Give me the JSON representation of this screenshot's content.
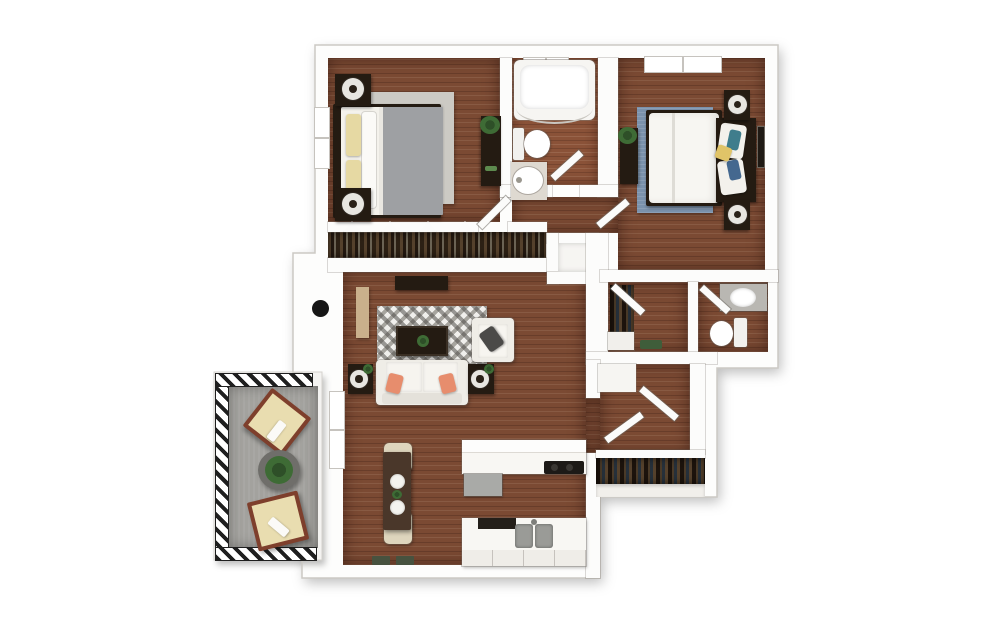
{
  "plan_title": "Two bedroom one and a half bath apartment 3D floor plan with balcony",
  "rooms": {
    "bedroom1": "Bedroom 1",
    "bathroom1": "Bathroom 1",
    "bedroom2": "Bedroom 2",
    "closet1": "Bedroom 1 wardrobe closet",
    "walkin_closet": "Walk-in closet",
    "bathroom2": "Bathroom 2",
    "living": "Living and dining room",
    "kitchen": "Kitchen",
    "hall": "Hallway",
    "hall_closet": "Hall closet",
    "entry": "Entry vestibule",
    "balcony": "Balcony"
  },
  "furniture": {
    "bedroom1": [
      "queen bed with gray comforter and yellow pillows",
      "two nightstands with lamps",
      "area rug",
      "dresser with plant",
      "window"
    ],
    "bathroom1": [
      "bathtub with shower curtain rod",
      "toilet",
      "pedestal sink"
    ],
    "bedroom2": [
      "queen bed with white comforter and blue accent pillows",
      "two nightstands with lamps",
      "blue area rug",
      "dresser with plant",
      "wall art",
      "window"
    ],
    "living": [
      "tv console",
      "tall cabinet",
      "geometric area rug",
      "coffee table with plant",
      "sofa with coral pillows",
      "two end tables with lamp and plant",
      "armchair with gray pillow"
    ],
    "dining": [
      "dining table",
      "two chairs",
      "two place settings",
      "centerpiece plant"
    ],
    "kitchen": [
      "breakfast-bar counter with cooktop and dishwasher",
      "sink counter with double basin and cabinets"
    ],
    "walkin_closet": [
      "hanging clothes rail",
      "storage bins",
      "shelf"
    ],
    "bathroom2": [
      "vanity with sink",
      "toilet"
    ],
    "hall_closet": [
      "hanging clothes rod",
      "shelf"
    ],
    "balcony": [
      "two lounge chairs with cushions and towels",
      "round table with plant"
    ],
    "closets": [
      "hanging clothes with sliding-door markers"
    ],
    "entry": [
      "front door knob"
    ]
  },
  "palette": {
    "background": "#ffffff",
    "wall_white": "#fdfdfc",
    "floor_wood": "#7b4a33",
    "floor_wood_light": "#8a5238",
    "balcony_concrete": "#a3a29e",
    "furniture_dark": "#241b12",
    "sofa_white": "#f2f0ea",
    "accent_coral": "#e78d6d",
    "accent_yellow": "#e0c468",
    "pillow_yellow": "#e6d9a3",
    "rug_gray": "#cccac4",
    "rug_blue": "#7b92ac",
    "plant_green": "#3e6b35",
    "lounge_cushion": "#e9ddb0",
    "lounge_frame": "#7e3f2c",
    "rail_hatch": "#1f1f1f"
  }
}
